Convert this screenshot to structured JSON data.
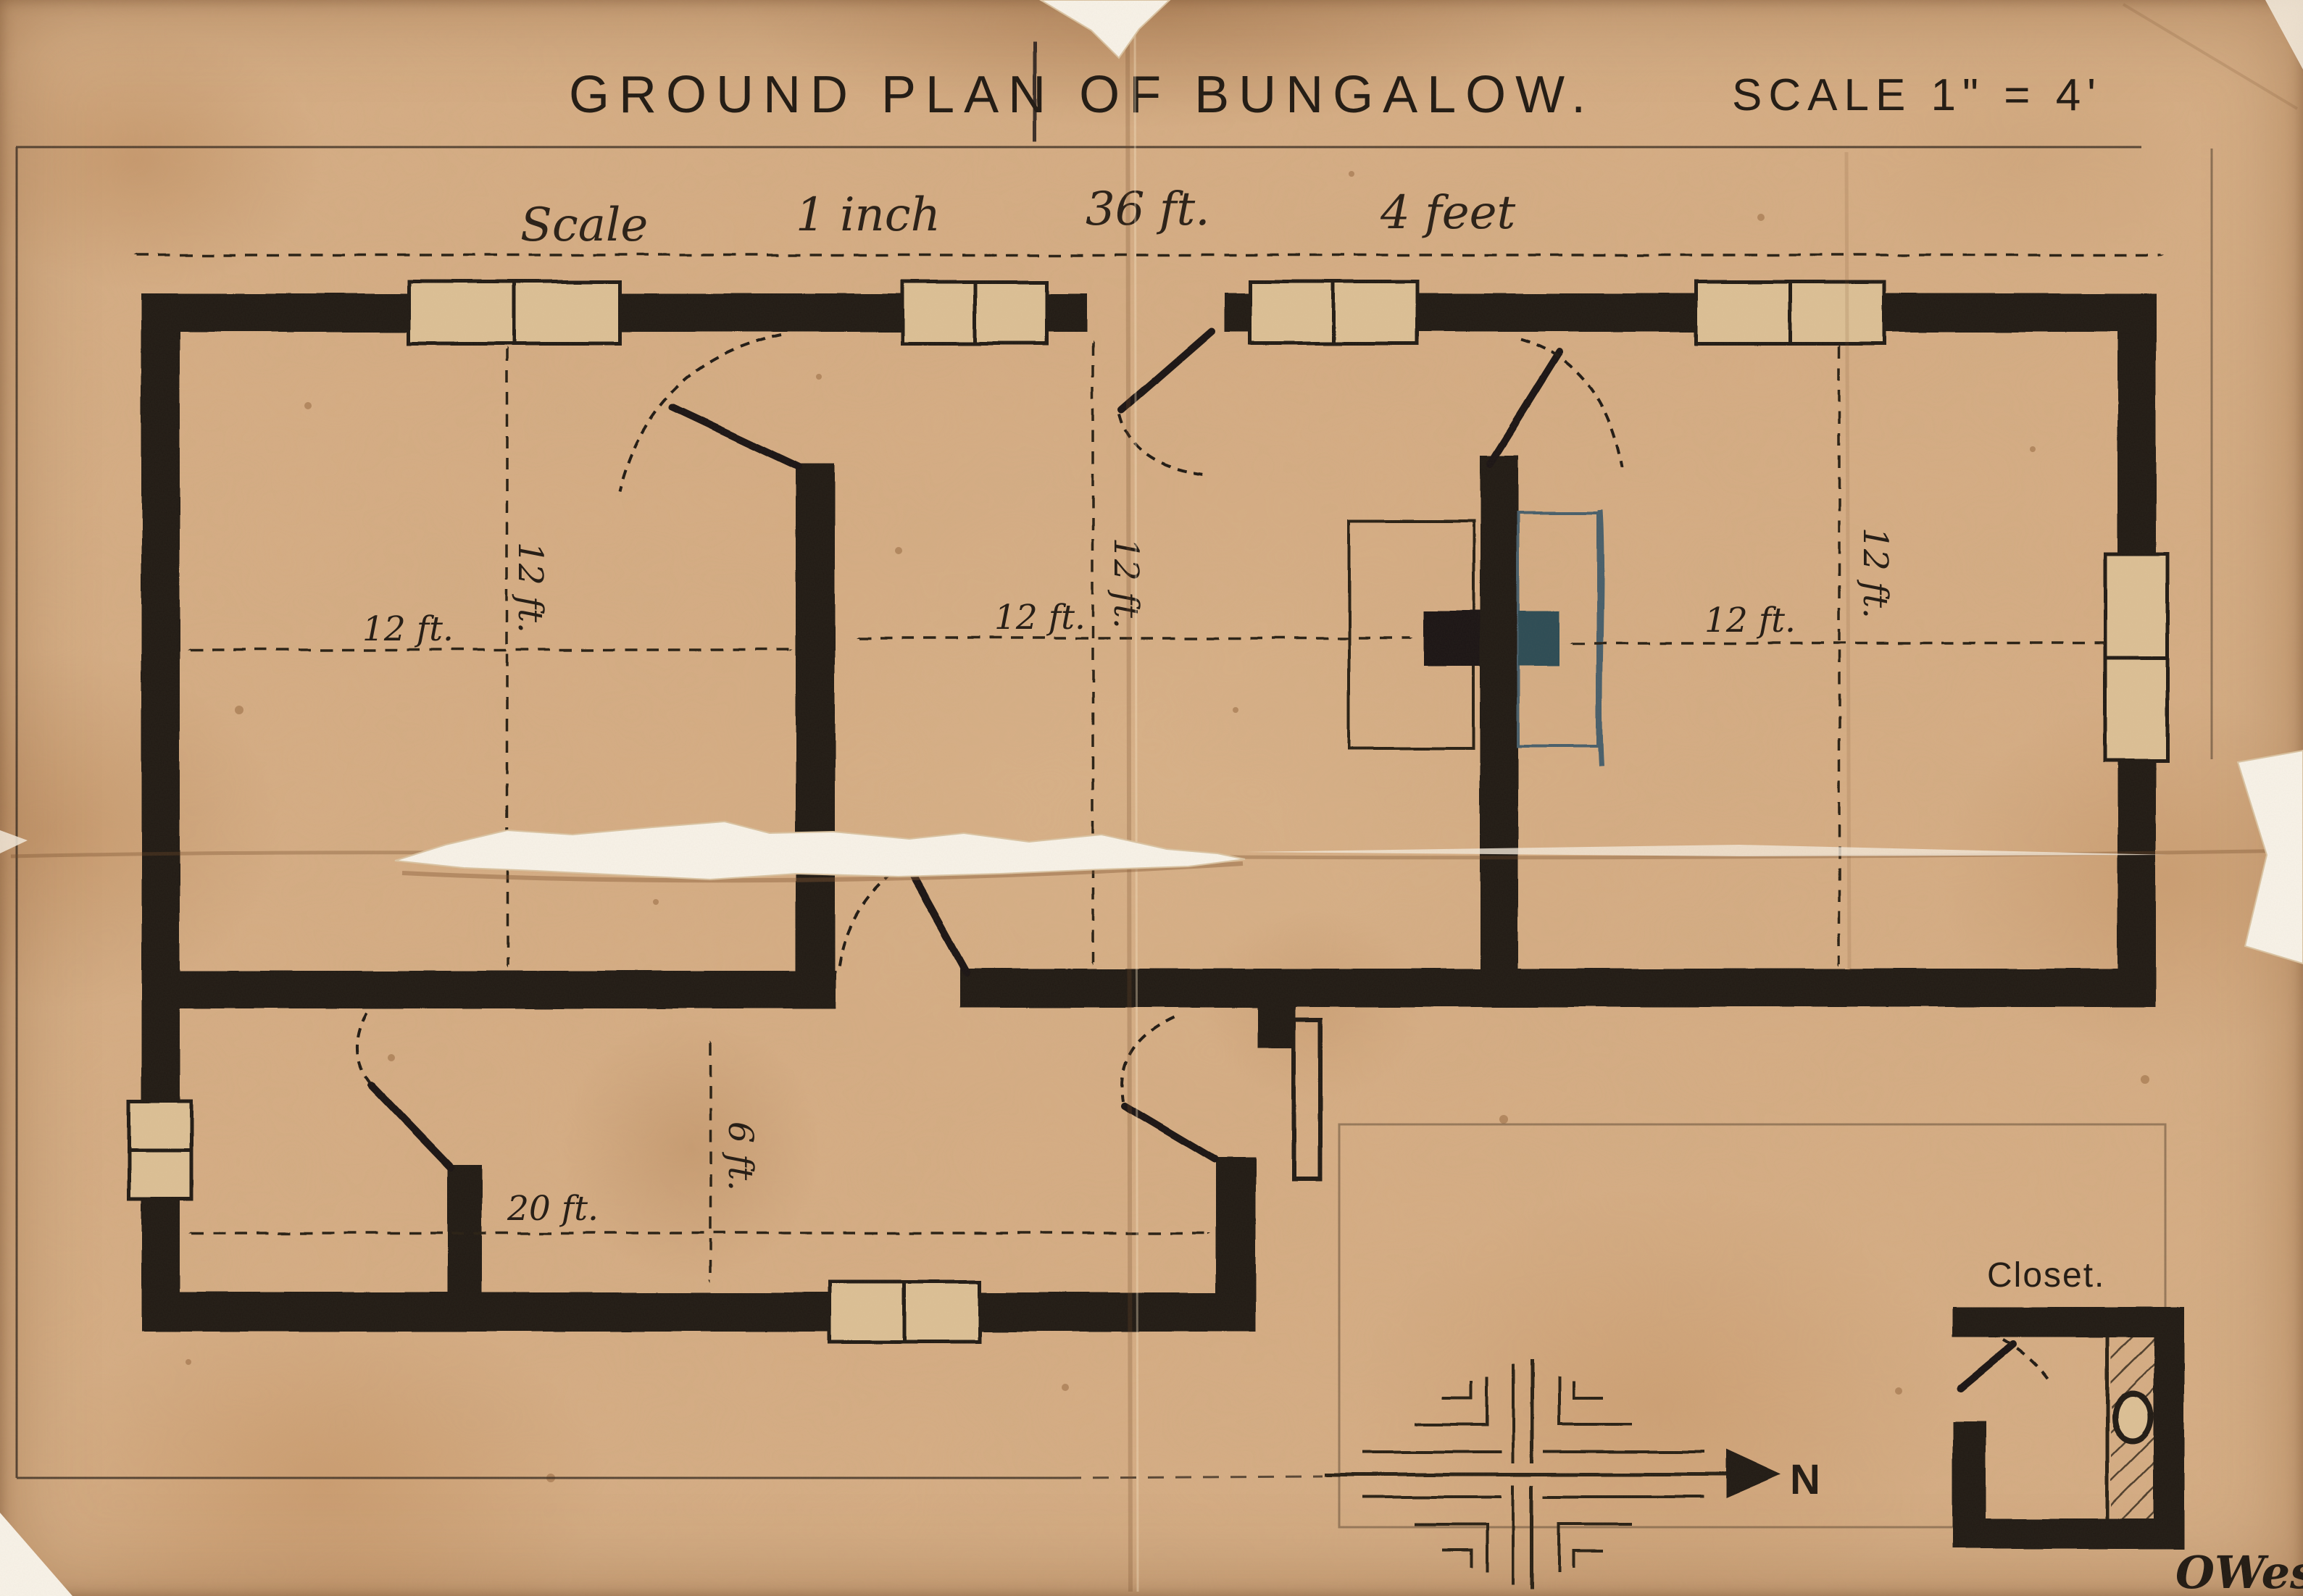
{
  "title": {
    "main": "GROUND PLAN OF BUNGALOW.",
    "scale_note": "SCALE 1\" = 4'"
  },
  "scale_line": {
    "w1": "Scale",
    "w2": "1 inch",
    "w3": "36 ft.",
    "w4": "4 feet"
  },
  "dims": {
    "left_w": "12 ft.",
    "left_d": "12 ft.",
    "hall_w": "12 ft.",
    "hall_d": "12 ft.",
    "right_w": "12 ft.",
    "right_d": "12 ft.",
    "wing_w": "20 ft.",
    "wing_d": "6 ft."
  },
  "labels": {
    "closet": "Closet.",
    "north": "N",
    "signature": "OWest"
  },
  "colors": {
    "paper": "#d6ae85",
    "ink": "#221b14",
    "pen_thin": "#2b2118",
    "blue_ink": "#49616c",
    "flue_teal": "#2e4d57",
    "signature_ink": "#24343c"
  }
}
